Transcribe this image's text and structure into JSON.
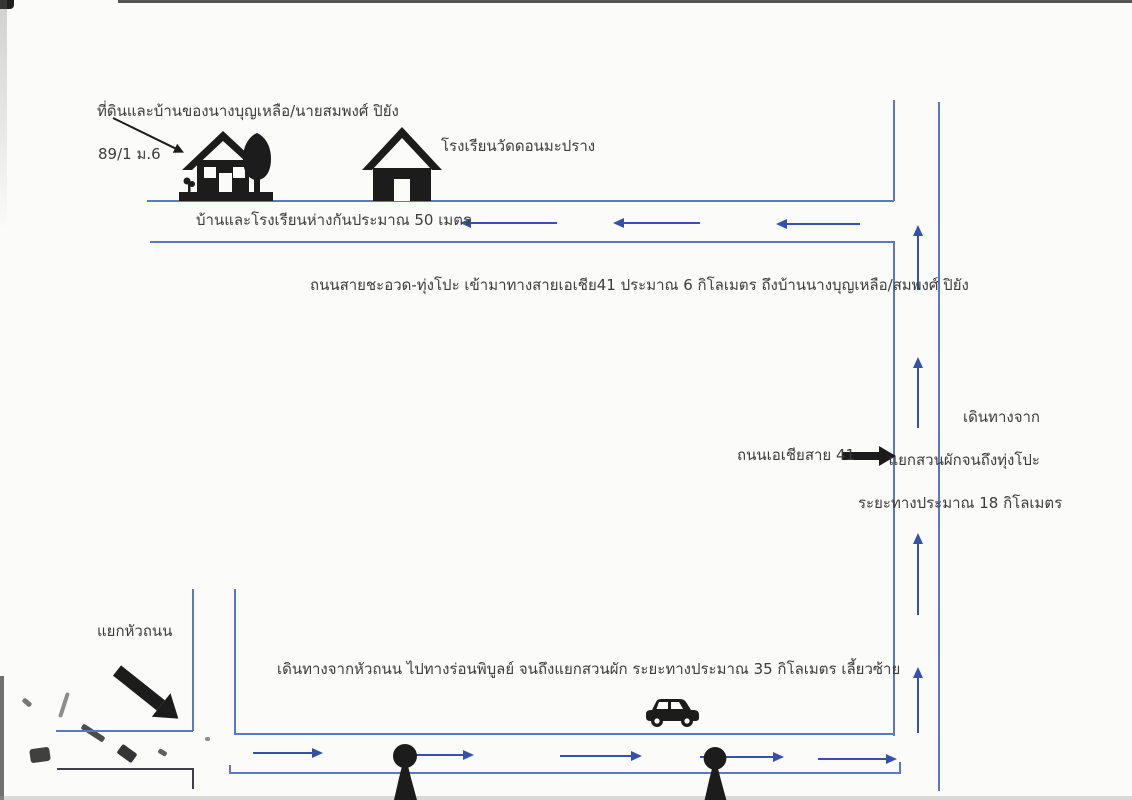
{
  "colors": {
    "paper": "#fbfbf9",
    "road": "#5b79c2",
    "arrow": "#3552a8",
    "ink": "#1c1c1c",
    "text": "#3c3c3c"
  },
  "labels": {
    "owner_annotation": "ที่ดินและบ้านของนางบุญเหลือ/นายสมพงศ์ ปิยัง",
    "address": "89/1 ม.6",
    "school": "โรงเรียนวัดดอนมะปราง",
    "house_school_distance": "บ้านและโรงเรียนห่างกันประมาณ 50 เมตร",
    "top_road_description": "ถนนสายชะอวด-ทุ่งโปะ เข้ามาทางสายเอเชีย41 ประมาณ 6 กิโลเมตร ถึงบ้านนางบุญเหลือ/สมพงศ์ ปิยัง",
    "highway_label": "ถนนเอเชียสาย 41",
    "right_route_line1": "เดินทางจาก",
    "right_route_line2": "แยกสวนผักจนถึงทุ่งโปะ",
    "right_route_line3": "ระยะทางประมาณ 18 กิโลเมตร",
    "junction_label": "แยกหัวถนน",
    "bottom_route_description": "เดินทางจากหัวถนน ไปทางร่อนพิบูลย์ จนถึงแยกสวนผัก ระยะทางประมาณ 35 กิโลเมตร เลี้ยวซ้าย"
  },
  "icons": {
    "house": "house-with-tree-icon",
    "school": "school-building-icon",
    "car": "car-icon",
    "tree_marker": "tree-marker-icon",
    "annotation_arrow": "annotation-arrow-icon",
    "junction_arrow": "junction-direction-arrow-icon",
    "highway_arrow": "highway-direction-arrow-icon"
  }
}
